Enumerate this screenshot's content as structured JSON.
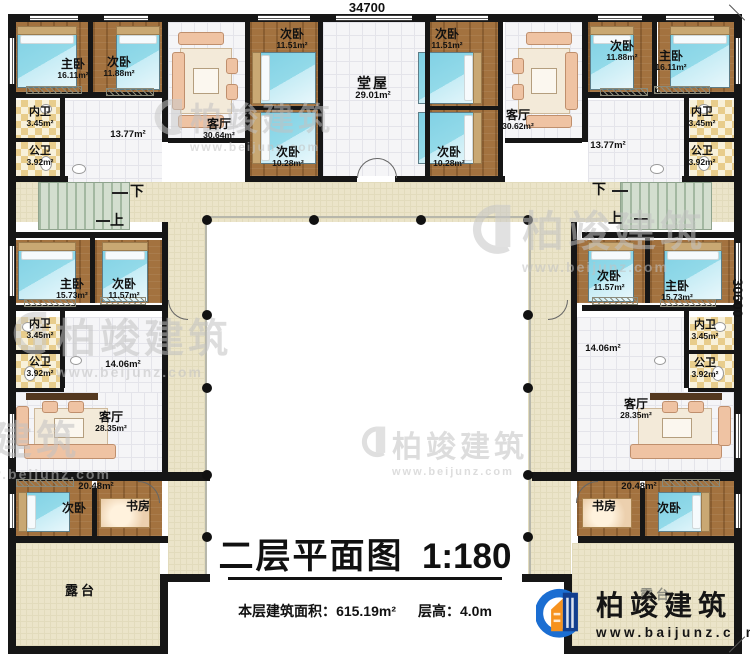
{
  "dims": {
    "top": "34700",
    "right": "30600"
  },
  "stairs": {
    "down": "下",
    "up": "上"
  },
  "rooms": {
    "tl_master": {
      "name": "主卧",
      "area": "16.11m²"
    },
    "tl_second": {
      "name": "次卧",
      "area": "11.88m²"
    },
    "tl_living": {
      "name": "客厅",
      "area": "30.64m²"
    },
    "tl_inner_bath": {
      "name": "内卫",
      "area": "3.45m²"
    },
    "tl_public_bath": {
      "name": "公卫",
      "area": "3.92m²"
    },
    "tl_hall": {
      "area": "13.77m²"
    },
    "tc_bed_lt": {
      "name": "次卧",
      "area": "11.51m²"
    },
    "tc_bed_lb": {
      "name": "次卧",
      "area": "10.28m²"
    },
    "tc_hall": {
      "name": "堂屋",
      "area": "29.01m²"
    },
    "tc_bed_rt": {
      "name": "次卧",
      "area": "11.51m²"
    },
    "tc_bed_rb": {
      "name": "次卧",
      "area": "10.28m²"
    },
    "tr_living": {
      "name": "客厅",
      "area": "30.62m²"
    },
    "tr_second": {
      "name": "次卧",
      "area": "11.88m²"
    },
    "tr_master": {
      "name": "主卧",
      "area": "16.11m²"
    },
    "tr_inner_bath": {
      "name": "内卫",
      "area": "3.45m²"
    },
    "tr_public_bath": {
      "name": "公卫",
      "area": "3.92m²"
    },
    "tr_hall": {
      "area": "13.77m²"
    },
    "ml_master": {
      "name": "主卧",
      "area": "15.73m²"
    },
    "ml_second": {
      "name": "次卧",
      "area": "11.57m²"
    },
    "ml_inner_bath": {
      "name": "内卫",
      "area": "3.45m²"
    },
    "ml_public_bath": {
      "name": "公卫",
      "area": "3.92m²"
    },
    "ml_hall": {
      "area": "14.06m²"
    },
    "ml_living": {
      "name": "客厅",
      "area": "28.35m²"
    },
    "bl_suite": {
      "area": "20.48m²"
    },
    "bl_bed": {
      "name": "次卧"
    },
    "bl_study": {
      "name": "书房"
    },
    "bl_terrace": {
      "name": "露台"
    },
    "mr_second": {
      "name": "次卧",
      "area": "11.57m²"
    },
    "mr_master": {
      "name": "主卧",
      "area": "15.73m²"
    },
    "mr_inner_bath": {
      "name": "内卫",
      "area": "3.45m²"
    },
    "mr_public_bath": {
      "name": "公卫",
      "area": "3.92m²"
    },
    "mr_hall": {
      "area": "14.06m²"
    },
    "mr_living": {
      "name": "客厅",
      "area": "28.35m²"
    },
    "br_suite": {
      "area": "20.48m²"
    },
    "br_study": {
      "name": "书房"
    },
    "br_bed": {
      "name": "次卧"
    },
    "br_terrace": {
      "name": "露台"
    }
  },
  "title": {
    "text": "二层平面图",
    "scale": "1:180"
  },
  "info": {
    "area_label": "本层建筑面积：",
    "area_value": "615.19m²",
    "height_label": "层高：",
    "height_value": "4.0m"
  },
  "logo": {
    "name": "柏竣建筑",
    "site": "www.baijunz.com"
  },
  "watermark": {
    "name": "柏竣建筑",
    "site": "www.beijunz.com"
  }
}
